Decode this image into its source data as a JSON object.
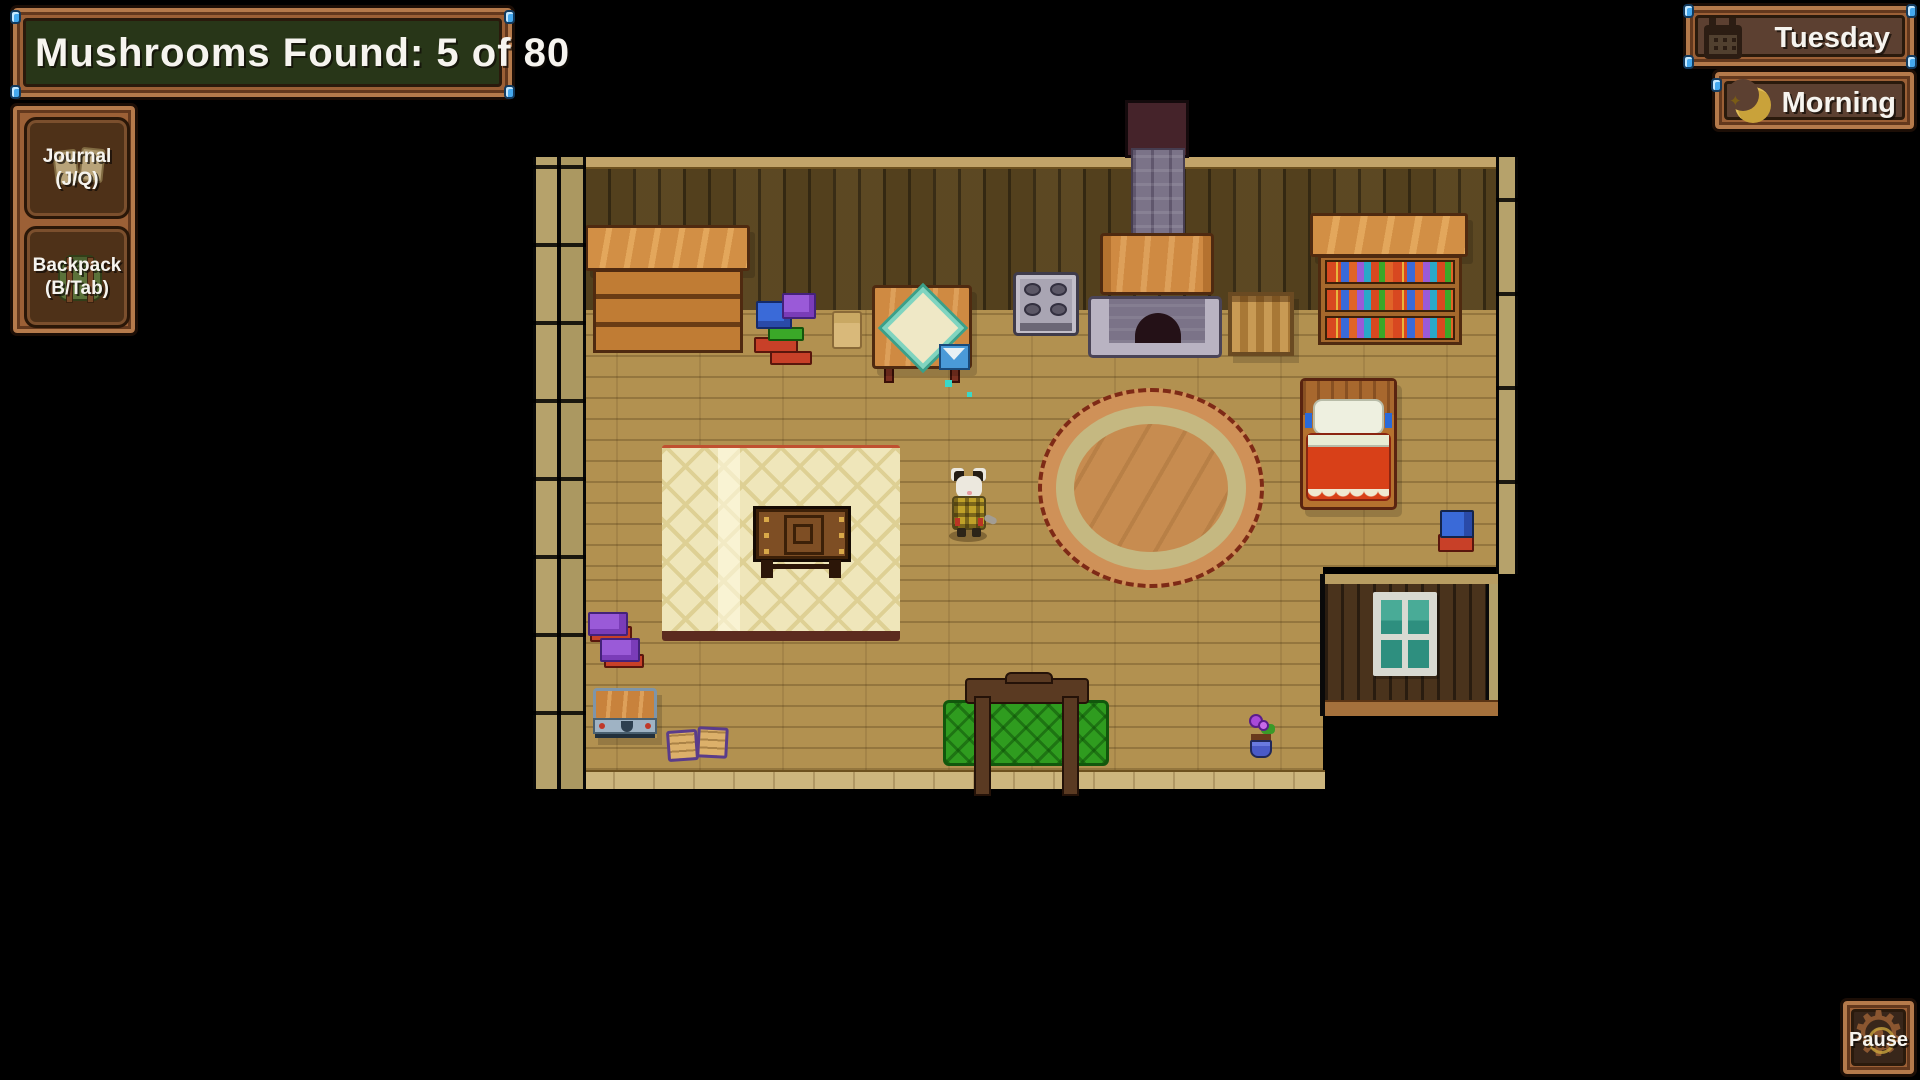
{
  "hud": {
    "mushroom_counter": {
      "label": "Mushrooms Found: 5 of 80",
      "found": 5,
      "total": 80
    },
    "journal": {
      "line1": "Journal",
      "line2": "(J/Q)",
      "icon": "journal-book-icon"
    },
    "backpack": {
      "line1": "Backpack",
      "line2": "(B/Tab)",
      "icon": "backpack-icon"
    },
    "day": {
      "label": "Tuesday",
      "icon": "calendar-icon"
    },
    "time": {
      "label": "Morning",
      "icon": "crescent-moon-icon",
      "star_glyph": "✦"
    },
    "pause": {
      "label": "Pause",
      "icon": "gear-icon",
      "gear_glyph": "⚙"
    }
  },
  "colors": {
    "frame_wood": "#9c6036",
    "counter_green": "#283618",
    "panel_brown": "#5c4031",
    "gem_blue": "#45a9ef",
    "wall_dark": "#53401d",
    "floor_tan": "#b29150",
    "couch_green": "#2f9c1f",
    "blanket_red": "#d84018",
    "moon_gold": "#c9a23a"
  },
  "scene": {
    "location": "cabin-interior-top-down",
    "objects": [
      "dresser",
      "book-pile",
      "paper-scrap",
      "side-table-with-cloth",
      "envelope",
      "stove",
      "fireplace",
      "chimney",
      "firewood-crate",
      "bookshelf",
      "bed",
      "bedside-book-stack",
      "area-rug",
      "writing-desk",
      "player-character",
      "round-rug",
      "purple-book-stack",
      "storage-chest",
      "open-book",
      "green-couch",
      "flower-pot",
      "window-alcove"
    ]
  }
}
